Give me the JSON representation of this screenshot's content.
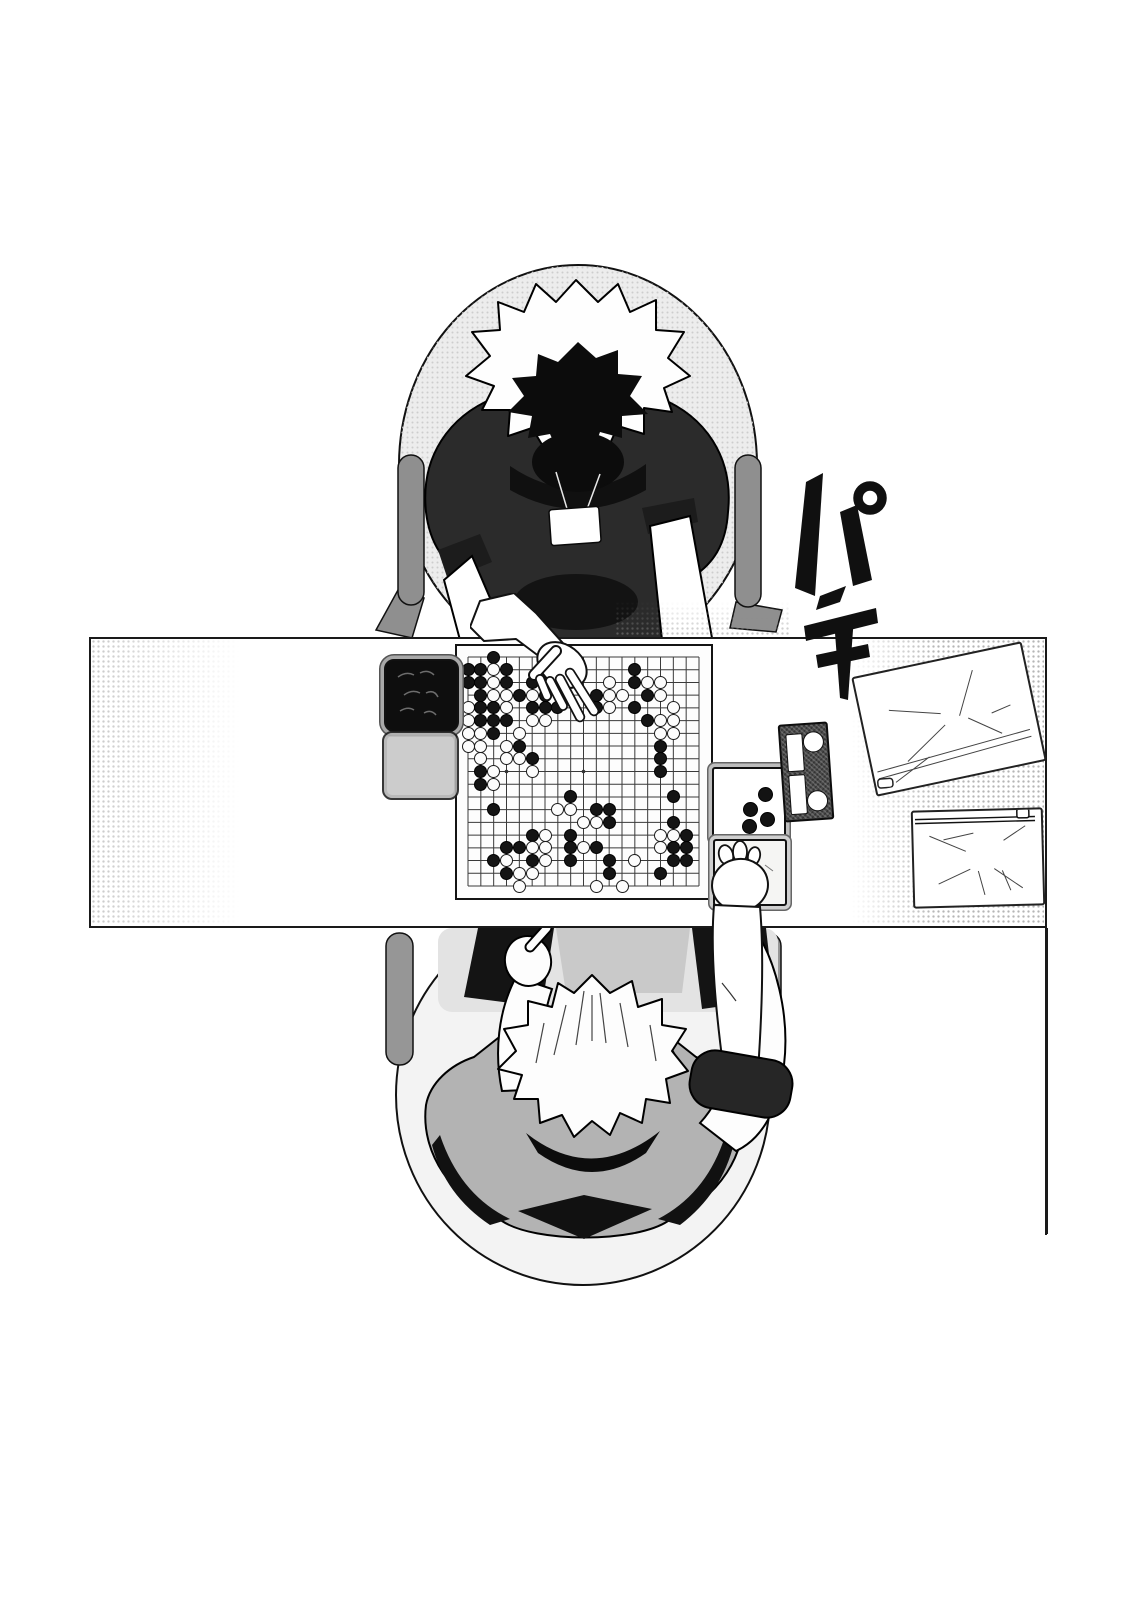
{
  "scene": {
    "sfx": {
      "text": "パチ"
    }
  },
  "board": {
    "size": 19,
    "star_points": [
      [
        4,
        4
      ],
      [
        10,
        4
      ],
      [
        16,
        4
      ],
      [
        4,
        10
      ],
      [
        10,
        10
      ],
      [
        16,
        10
      ],
      [
        4,
        16
      ],
      [
        10,
        16
      ],
      [
        16,
        16
      ]
    ],
    "stones": [
      [
        3,
        1,
        "b"
      ],
      [
        1,
        2,
        "b"
      ],
      [
        2,
        2,
        "b"
      ],
      [
        3,
        2,
        "w"
      ],
      [
        4,
        2,
        "b"
      ],
      [
        1,
        3,
        "b"
      ],
      [
        2,
        3,
        "b"
      ],
      [
        3,
        3,
        "w"
      ],
      [
        4,
        3,
        "b"
      ],
      [
        6,
        3,
        "b"
      ],
      [
        7,
        3,
        "b"
      ],
      [
        2,
        4,
        "b"
      ],
      [
        3,
        4,
        "w"
      ],
      [
        4,
        4,
        "w"
      ],
      [
        5,
        4,
        "b"
      ],
      [
        6,
        4,
        "w"
      ],
      [
        7,
        4,
        "b"
      ],
      [
        1,
        5,
        "w"
      ],
      [
        2,
        5,
        "b"
      ],
      [
        3,
        5,
        "b"
      ],
      [
        4,
        5,
        "w"
      ],
      [
        6,
        5,
        "b"
      ],
      [
        7,
        5,
        "b"
      ],
      [
        8,
        5,
        "b"
      ],
      [
        1,
        6,
        "w"
      ],
      [
        2,
        6,
        "b"
      ],
      [
        3,
        6,
        "b"
      ],
      [
        4,
        6,
        "b"
      ],
      [
        6,
        6,
        "w"
      ],
      [
        7,
        6,
        "w"
      ],
      [
        1,
        7,
        "w"
      ],
      [
        2,
        7,
        "w"
      ],
      [
        3,
        7,
        "b"
      ],
      [
        5,
        7,
        "w"
      ],
      [
        1,
        8,
        "w"
      ],
      [
        2,
        8,
        "w"
      ],
      [
        4,
        8,
        "w"
      ],
      [
        5,
        8,
        "b"
      ],
      [
        2,
        9,
        "w"
      ],
      [
        4,
        9,
        "w"
      ],
      [
        5,
        9,
        "w"
      ],
      [
        6,
        9,
        "b"
      ],
      [
        2,
        10,
        "b"
      ],
      [
        3,
        10,
        "w"
      ],
      [
        6,
        10,
        "w"
      ],
      [
        2,
        11,
        "b"
      ],
      [
        3,
        11,
        "w"
      ],
      [
        3,
        13,
        "b"
      ],
      [
        12,
        3,
        "w"
      ],
      [
        11,
        4,
        "b"
      ],
      [
        12,
        4,
        "w"
      ],
      [
        13,
        4,
        "w"
      ],
      [
        11,
        5,
        "b"
      ],
      [
        12,
        5,
        "w"
      ],
      [
        14,
        2,
        "b"
      ],
      [
        14,
        3,
        "b"
      ],
      [
        15,
        3,
        "w"
      ],
      [
        16,
        3,
        "w"
      ],
      [
        15,
        4,
        "b"
      ],
      [
        16,
        4,
        "w"
      ],
      [
        14,
        5,
        "b"
      ],
      [
        17,
        5,
        "w"
      ],
      [
        15,
        6,
        "b"
      ],
      [
        16,
        6,
        "w"
      ],
      [
        17,
        6,
        "w"
      ],
      [
        16,
        7,
        "w"
      ],
      [
        17,
        7,
        "w"
      ],
      [
        16,
        8,
        "b"
      ],
      [
        16,
        9,
        "b"
      ],
      [
        16,
        10,
        "b"
      ],
      [
        17,
        12,
        "b"
      ],
      [
        9,
        12,
        "b"
      ],
      [
        8,
        13,
        "w"
      ],
      [
        9,
        13,
        "w"
      ],
      [
        11,
        13,
        "b"
      ],
      [
        12,
        13,
        "b"
      ],
      [
        10,
        14,
        "w"
      ],
      [
        11,
        14,
        "w"
      ],
      [
        12,
        14,
        "b"
      ],
      [
        17,
        14,
        "b"
      ],
      [
        6,
        15,
        "b"
      ],
      [
        7,
        15,
        "w"
      ],
      [
        9,
        15,
        "b"
      ],
      [
        16,
        15,
        "w"
      ],
      [
        17,
        15,
        "w"
      ],
      [
        18,
        15,
        "b"
      ],
      [
        4,
        16,
        "b"
      ],
      [
        5,
        16,
        "b"
      ],
      [
        6,
        16,
        "w"
      ],
      [
        7,
        16,
        "w"
      ],
      [
        9,
        16,
        "b"
      ],
      [
        10,
        16,
        "w"
      ],
      [
        11,
        16,
        "b"
      ],
      [
        16,
        16,
        "w"
      ],
      [
        17,
        16,
        "b"
      ],
      [
        18,
        16,
        "b"
      ],
      [
        3,
        17,
        "b"
      ],
      [
        4,
        17,
        "w"
      ],
      [
        6,
        17,
        "b"
      ],
      [
        7,
        17,
        "w"
      ],
      [
        9,
        17,
        "b"
      ],
      [
        12,
        17,
        "b"
      ],
      [
        14,
        17,
        "w"
      ],
      [
        17,
        17,
        "b"
      ],
      [
        18,
        17,
        "b"
      ],
      [
        4,
        18,
        "b"
      ],
      [
        5,
        18,
        "w"
      ],
      [
        6,
        18,
        "w"
      ],
      [
        12,
        18,
        "b"
      ],
      [
        16,
        18,
        "b"
      ],
      [
        5,
        19,
        "w"
      ],
      [
        11,
        19,
        "w"
      ],
      [
        13,
        19,
        "w"
      ]
    ]
  },
  "captures": {
    "tray_black_count": 4,
    "tray_positions": [
      [
        44,
        18
      ],
      [
        29,
        33
      ],
      [
        46,
        43
      ],
      [
        28,
        50
      ]
    ]
  },
  "equipment": {
    "black_stone_bowl": "bowl-of-black-stones",
    "white_stone_bowl": "stone-bowl-lid",
    "game_clock_displays": 2,
    "game_clock_buttons": 2,
    "pouches": 2,
    "trays": 2
  },
  "colors": {
    "ink": "#111111",
    "paper": "#ffffff",
    "top_player_shirt": "#2b2b2b",
    "bottom_player_shirt": "#b3b3b3",
    "chair_gray": "#969696"
  }
}
